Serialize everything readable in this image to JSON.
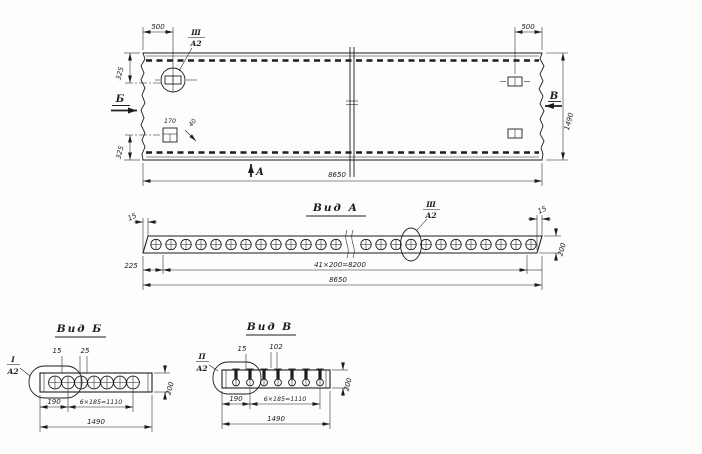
{
  "ink": "#1d1d1d",
  "plan": {
    "dim_top_left": "500",
    "dim_top_right": "500",
    "dim_left_upper": "325",
    "dim_left_lower": "325",
    "dim_right_height": "1490",
    "dim_bottom_length": "8650",
    "detail_width": "170",
    "detail_offset": "40",
    "arrow_left": "Б",
    "arrow_right": "В",
    "arrow_bottom": "А",
    "callout": {
      "num": "Ш",
      "den": "А2"
    }
  },
  "view_a": {
    "title": "Вид А",
    "callout": {
      "num": "Ш",
      "den": "А2"
    },
    "dim_end_left": "15",
    "dim_end_right": "15",
    "dim_height": "200",
    "dim_first": "225",
    "dim_holes": "41×200=8200",
    "dim_total": "8650"
  },
  "view_b": {
    "title": "Вид Б",
    "callout": {
      "num": "I",
      "den": "А2"
    },
    "dim_end": "15",
    "dim_gap": "25",
    "dim_first": "190",
    "dim_holes": "6×185=1110",
    "dim_total": "1490",
    "dim_height": "200"
  },
  "view_v": {
    "title": "Вид В",
    "callout": {
      "num": "П",
      "den": "А2"
    },
    "dim_end": "15",
    "dim_slot": "102",
    "dim_first": "190",
    "dim_holes": "6×185=1110",
    "dim_total": "1490",
    "dim_height": "200"
  }
}
